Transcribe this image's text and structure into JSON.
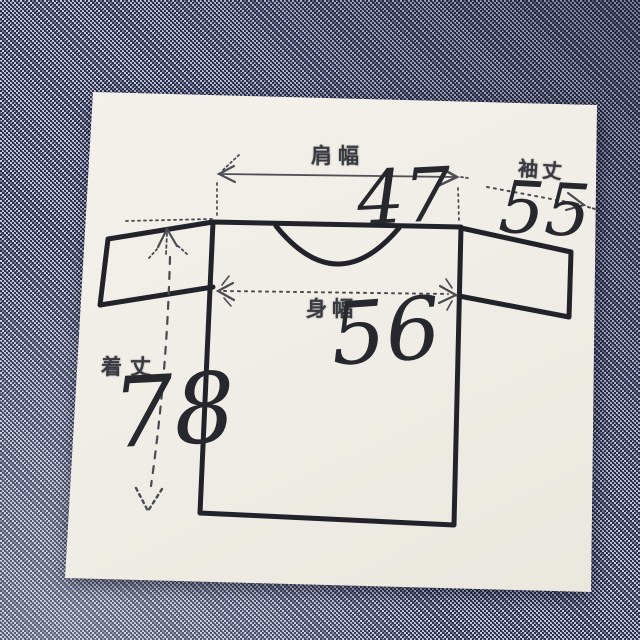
{
  "measurements": {
    "shoulder_width": {
      "label": "肩幅",
      "value": "47"
    },
    "sleeve_length": {
      "label": "袖丈",
      "value": "55"
    },
    "body_width": {
      "label": "身幅",
      "value": "56"
    },
    "garment_length": {
      "label": "着丈",
      "value": "78"
    }
  },
  "colors": {
    "fabric_navy": "#2c3152",
    "fabric_thread": "#c7cbd9",
    "card_paper": "#f1efe8",
    "print_ink": "#3a3a41",
    "pen_ink": "#27272e"
  }
}
